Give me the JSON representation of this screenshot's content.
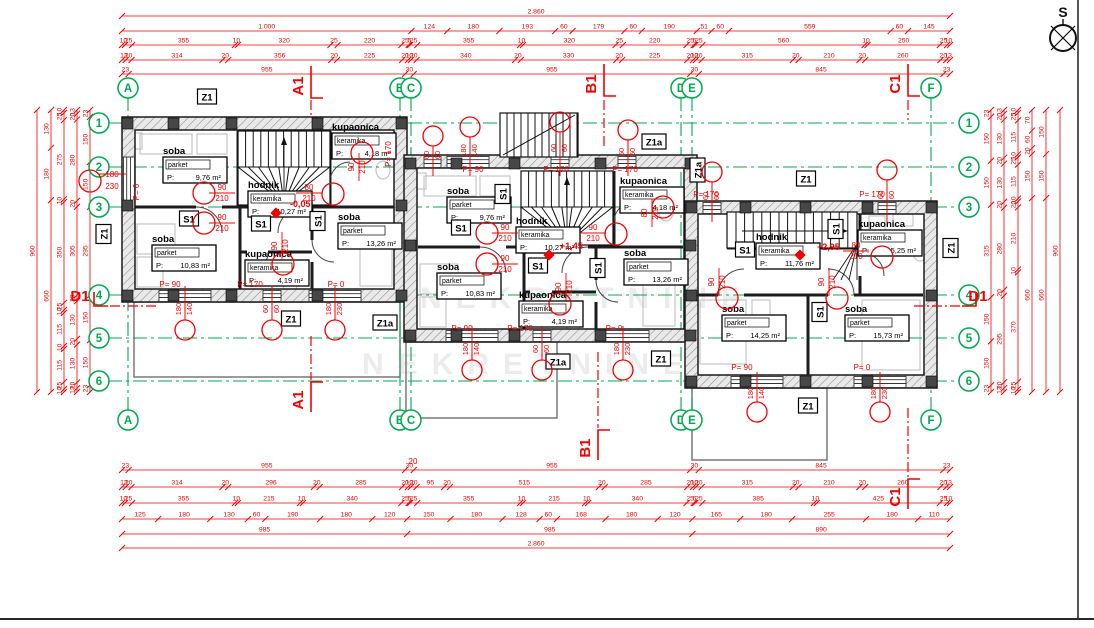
{
  "colors": {
    "red": "#f40000",
    "green": "#00a84f",
    "wall": "#1a1a1a",
    "furniture": "#c6c6c6",
    "terrace": "#6e6e6e",
    "watermark": "#ececec"
  },
  "compass": {
    "label": "S"
  },
  "watermark": {
    "text": "NEKRETNINE"
  },
  "axes": {
    "col_bubbles": [
      {
        "id": "A",
        "x": 128
      },
      {
        "id": "B",
        "x": 400
      },
      {
        "id": "C",
        "x": 411
      },
      {
        "id": "D",
        "x": 681
      },
      {
        "id": "E",
        "x": 692
      },
      {
        "id": "F",
        "x": 931
      }
    ],
    "row_bubbles": [
      {
        "id": "1",
        "y": 123
      },
      {
        "id": "2",
        "y": 167
      },
      {
        "id": "3",
        "y": 207
      },
      {
        "id": "4",
        "y": 295
      },
      {
        "id": "5",
        "y": 338
      },
      {
        "id": "6",
        "y": 381
      }
    ]
  },
  "dimensions": {
    "top": [
      {
        "y": 16,
        "values": [
          "2.860"
        ]
      },
      {
        "y": 31,
        "values": [
          "1.000",
          "124",
          "180",
          "193",
          "60",
          "179",
          "60",
          "190",
          "51",
          "60",
          "559",
          "60",
          "145"
        ]
      },
      {
        "y": 45,
        "values": [
          "10",
          "25",
          "355",
          "10",
          "320",
          "25",
          "220",
          "25",
          "5",
          "25",
          "355",
          "10",
          "320",
          "25",
          "220",
          "25",
          "5",
          "25",
          "560",
          "10",
          "250",
          "25",
          "10"
        ]
      },
      {
        "y": 60,
        "values": [
          "13",
          "20",
          "314",
          "20",
          "356",
          "20",
          "225",
          "20",
          "10",
          "20",
          "340",
          "20",
          "330",
          "20",
          "225",
          "20",
          "10",
          "20",
          "315",
          "20",
          "210",
          "20",
          "260",
          "20",
          "13"
        ]
      },
      {
        "y": 74,
        "values": [
          "23",
          "955",
          "30",
          "955",
          "30",
          "845",
          "23"
        ]
      }
    ],
    "bottom": [
      {
        "y": 470,
        "values": [
          "23",
          "955",
          "30",
          "955",
          "30",
          "845",
          "23"
        ]
      },
      {
        "y": 487,
        "values": [
          "13",
          "20",
          "314",
          "20",
          "296",
          "20",
          "285",
          "20",
          "10",
          "20",
          "95",
          "20",
          "515",
          "20",
          "285",
          "20",
          "10",
          "20",
          "315",
          "20",
          "210",
          "20",
          "260",
          "20",
          "13"
        ]
      },
      {
        "y": 503,
        "values": [
          "10",
          "25",
          "355",
          "10",
          "215",
          "10",
          "340",
          "25",
          "5",
          "25",
          "355",
          "10",
          "215",
          "10",
          "340",
          "25",
          "5",
          "25",
          "385",
          "10",
          "425",
          "25",
          "10"
        ]
      },
      {
        "y": 519,
        "values": [
          "125",
          "180",
          "130",
          "60",
          "190",
          "180",
          "120",
          "150",
          "180",
          "128",
          "60",
          "168",
          "180",
          "120",
          "165",
          "180",
          "255",
          "180",
          "110"
        ]
      },
      {
        "y": 534,
        "values": [
          "985",
          "985",
          "890"
        ]
      },
      {
        "y": 548,
        "values": [
          "2.860"
        ]
      }
    ],
    "left": [
      {
        "x": 37,
        "values": [
          "960"
        ]
      },
      {
        "x": 51,
        "values": [
          "130",
          "180",
          "660"
        ]
      },
      {
        "x": 64,
        "values": [
          "10",
          "25",
          "275",
          "10",
          "350",
          "25",
          "10",
          "115",
          "10",
          "115",
          "25",
          "10"
        ]
      },
      {
        "x": 77,
        "values": [
          "13",
          "20",
          "280",
          "20",
          "305",
          "20",
          "130",
          "20",
          "130",
          "20",
          "13"
        ]
      },
      {
        "x": 90,
        "values": [
          "23",
          "150",
          "150",
          "295",
          "150",
          "150",
          "23"
        ]
      }
    ],
    "right": [
      {
        "x": 991,
        "values": [
          "23",
          "150",
          "150",
          "315",
          "150",
          "150",
          "23"
        ]
      },
      {
        "x": 1004,
        "values": [
          "13",
          "20",
          "130",
          "20",
          "130",
          "20",
          "280",
          "20",
          "295",
          "20",
          "13"
        ]
      },
      {
        "x": 1018,
        "values": [
          "10",
          "25",
          "115",
          "10",
          "25",
          "115",
          "10",
          "20",
          "210",
          "10",
          "370",
          "25",
          "10"
        ]
      },
      {
        "x": 1032,
        "values": [
          "70",
          "60",
          "20",
          "150",
          "660"
        ]
      },
      {
        "x": 1046,
        "values": [
          "150",
          "150",
          "660"
        ]
      },
      {
        "x": 1060,
        "values": [
          "960"
        ]
      }
    ]
  },
  "sections": [
    {
      "t": "A1",
      "x": 303,
      "y": 86,
      "rot": true,
      "brk": [
        [
          311,
          66
        ],
        [
          311,
          98
        ],
        [
          323,
          98
        ]
      ],
      "dash": [
        311,
        100,
        311,
        116
      ]
    },
    {
      "t": "B1",
      "x": 596,
      "y": 84,
      "rot": true,
      "brk": [
        [
          604,
          64
        ],
        [
          604,
          96
        ],
        [
          616,
          96
        ]
      ],
      "dash": [
        604,
        100,
        604,
        148
      ]
    },
    {
      "t": "C1",
      "x": 900,
      "y": 84,
      "rot": true,
      "brk": [
        [
          908,
          64
        ],
        [
          908,
          96
        ],
        [
          920,
          96
        ]
      ],
      "dash": [
        908,
        100,
        908,
        120
      ]
    },
    {
      "t": "A1",
      "x": 303,
      "y": 400,
      "rot": true,
      "brk": [
        [
          311,
          412
        ],
        [
          311,
          382
        ],
        [
          323,
          382
        ]
      ],
      "dash": [
        311,
        336,
        311,
        380
      ]
    },
    {
      "t": "B1",
      "x": 590,
      "y": 448,
      "rot": true,
      "brk": [
        [
          598,
          460
        ],
        [
          598,
          430
        ],
        [
          610,
          430
        ]
      ],
      "dash": [
        598,
        352,
        598,
        428
      ]
    },
    {
      "t": "C1",
      "x": 900,
      "y": 497,
      "rot": true,
      "brk": [
        [
          908,
          509
        ],
        [
          908,
          479
        ],
        [
          920,
          479
        ]
      ],
      "dash": [
        908,
        408,
        908,
        477
      ]
    },
    {
      "t": "D1",
      "x": 80,
      "y": 301,
      "rot": false,
      "brk": [
        [
          94,
          292
        ],
        [
          94,
          306
        ],
        [
          108,
          306
        ]
      ],
      "dash": [
        110,
        306,
        158,
        306
      ]
    },
    {
      "t": "D1",
      "x": 978,
      "y": 301,
      "rot": false,
      "brk": [
        [
          976,
          292
        ],
        [
          976,
          306
        ],
        [
          962,
          306
        ]
      ],
      "dash": [
        960,
        306,
        914,
        306
      ]
    }
  ],
  "rooms": [
    {
      "n": "soba",
      "m": "parket",
      "a": "9,76",
      "x": 163,
      "y": 154
    },
    {
      "n": "kupaonica",
      "m": "keramika",
      "a": "4,18",
      "x": 332,
      "y": 130
    },
    {
      "n": "hodnik",
      "m": "keramika",
      "a": "10,27",
      "x": 248,
      "y": 188
    },
    {
      "n": "soba",
      "m": "parket",
      "a": "10,83",
      "x": 152,
      "y": 242
    },
    {
      "n": "kupaonica",
      "m": "keramika",
      "a": "4,19",
      "x": 245,
      "y": 257
    },
    {
      "n": "soba",
      "m": "parket",
      "a": "13,26",
      "x": 338,
      "y": 220
    },
    {
      "n": "soba",
      "m": "parket",
      "a": "9,76",
      "x": 447,
      "y": 194
    },
    {
      "n": "kupaonica",
      "m": "keramika",
      "a": "4,18",
      "x": 620,
      "y": 184
    },
    {
      "n": "hodnik",
      "m": "keramika",
      "a": "10,27",
      "x": 516,
      "y": 224
    },
    {
      "n": "soba",
      "m": "parket",
      "a": "10,83",
      "x": 437,
      "y": 270
    },
    {
      "n": "kupaonica",
      "m": "keramika",
      "a": "4,19",
      "x": 519,
      "y": 298
    },
    {
      "n": "soba",
      "m": "parket",
      "a": "13,26",
      "x": 624,
      "y": 256
    },
    {
      "n": "hodnik",
      "m": "keramika",
      "a": "11,76",
      "x": 756,
      "y": 240
    },
    {
      "n": "kupaonica",
      "m": "keramika",
      "a": "5,25",
      "x": 858,
      "y": 227
    },
    {
      "n": "soba",
      "m": "parket",
      "a": "14,25",
      "x": 722,
      "y": 312
    },
    {
      "n": "soba",
      "m": "parket",
      "a": "15,73",
      "x": 845,
      "y": 312
    }
  ],
  "markers": [
    {
      "t": "Z1",
      "x": 207,
      "y": 97,
      "rot": false
    },
    {
      "t": "Z1",
      "x": 104,
      "y": 234,
      "rot": true
    },
    {
      "t": "Z1",
      "x": 291,
      "y": 319,
      "rot": false
    },
    {
      "t": "Z1a",
      "x": 385,
      "y": 323,
      "rot": false
    },
    {
      "t": "Z1a",
      "x": 654,
      "y": 142,
      "rot": false
    },
    {
      "t": "Z1a",
      "x": 558,
      "y": 362,
      "rot": false
    },
    {
      "t": "Z1",
      "x": 661,
      "y": 359,
      "rot": false
    },
    {
      "t": "Z1a",
      "x": 698,
      "y": 170,
      "rot": true
    },
    {
      "t": "Z1",
      "x": 806,
      "y": 179,
      "rot": false
    },
    {
      "t": "Z1",
      "x": 951,
      "y": 248,
      "rot": true
    },
    {
      "t": "Z1",
      "x": 808,
      "y": 406,
      "rot": false
    },
    {
      "t": "S1",
      "x": 189,
      "y": 219,
      "rot": false
    },
    {
      "t": "S1",
      "x": 261,
      "y": 224,
      "rot": false
    },
    {
      "t": "S1",
      "x": 318,
      "y": 221,
      "rot": true
    },
    {
      "t": "S1",
      "x": 461,
      "y": 228,
      "rot": false
    },
    {
      "t": "S1",
      "x": 503,
      "y": 194,
      "rot": true
    },
    {
      "t": "S1",
      "x": 538,
      "y": 266,
      "rot": false
    },
    {
      "t": "S1",
      "x": 598,
      "y": 268,
      "rot": true
    },
    {
      "t": "S1",
      "x": 745,
      "y": 250,
      "rot": false
    },
    {
      "t": "S1",
      "x": 836,
      "y": 229,
      "rot": true
    },
    {
      "t": "S1",
      "x": 820,
      "y": 312,
      "rot": true
    }
  ],
  "levels": [
    {
      "t": "-0,05",
      "x": 288,
      "y": 207,
      "dx": 276,
      "dy": 213
    },
    {
      "t": "+1,45",
      "x": 558,
      "y": 249,
      "dx": 549,
      "dy": 255
    },
    {
      "t": "+2,95",
      "x": 815,
      "y": 250,
      "dx": 800,
      "dy": 255
    }
  ],
  "red_notes": [
    {
      "t": "20",
      "x": 413,
      "y": 464,
      "r": 0
    },
    {
      "t": "P= 0",
      "x": 139,
      "y": 192,
      "r": 1
    },
    {
      "t": "180",
      "x": 112,
      "y": 177,
      "r": 0
    },
    {
      "t": "230",
      "x": 112,
      "y": 189,
      "r": 0
    },
    {
      "t": "P= 170",
      "x": 391,
      "y": 154,
      "r": 1
    },
    {
      "t": "P= 90",
      "x": 170,
      "y": 287,
      "r": 0
    },
    {
      "t": "P= 170",
      "x": 250,
      "y": 287,
      "r": 0
    },
    {
      "t": "P= 0",
      "x": 336,
      "y": 287,
      "r": 0
    },
    {
      "t": "P= 90",
      "x": 473,
      "y": 172,
      "r": 0
    },
    {
      "t": "P= 170",
      "x": 556,
      "y": 172,
      "r": 0
    },
    {
      "t": "P= 170",
      "x": 625,
      "y": 172,
      "r": 0
    },
    {
      "t": "P= 90",
      "x": 462,
      "y": 331,
      "r": 0
    },
    {
      "t": "P= 170",
      "x": 520,
      "y": 331,
      "r": 0
    },
    {
      "t": "P= 0",
      "x": 614,
      "y": 331,
      "r": 0
    },
    {
      "t": "P= 170",
      "x": 706,
      "y": 197,
      "r": 0
    },
    {
      "t": "P= 170",
      "x": 872,
      "y": 197,
      "r": 0
    },
    {
      "t": "P= 90",
      "x": 742,
      "y": 370,
      "r": 0
    },
    {
      "t": "P= 0",
      "x": 862,
      "y": 370,
      "r": 0
    }
  ],
  "door_tags": [
    {
      "w": "90",
      "h": "210",
      "x": 222,
      "y": 190,
      "rot": false
    },
    {
      "w": "80",
      "h": "210",
      "x": 309,
      "y": 190,
      "rot": false
    },
    {
      "w": "90",
      "h": "210",
      "x": 222,
      "y": 220,
      "rot": false
    },
    {
      "w": "90",
      "h": "210",
      "x": 277,
      "y": 246,
      "rot": true
    },
    {
      "w": "90",
      "h": "210",
      "x": 354,
      "y": 167,
      "rot": true
    },
    {
      "w": "90",
      "h": "210",
      "x": 505,
      "y": 230,
      "rot": false
    },
    {
      "w": "90",
      "h": "210",
      "x": 593,
      "y": 230,
      "rot": false
    },
    {
      "w": "90",
      "h": "210",
      "x": 505,
      "y": 261,
      "rot": false
    },
    {
      "w": "90",
      "h": "210",
      "x": 561,
      "y": 287,
      "rot": true
    },
    {
      "w": "80",
      "h": "210",
      "x": 647,
      "y": 213,
      "rot": true
    },
    {
      "w": "90",
      "h": "210",
      "x": 714,
      "y": 282,
      "rot": true
    },
    {
      "w": "90",
      "h": "210",
      "x": 824,
      "y": 282,
      "rot": true
    },
    {
      "w": "80",
      "h": "210",
      "x": 856,
      "y": 248,
      "rot": false
    }
  ],
  "window_tags": [
    {
      "x": 185,
      "cy": 330,
      "wy": 302,
      "a": "180",
      "b": "140"
    },
    {
      "x": 272,
      "cy": 330,
      "wy": 302,
      "a": "60",
      "b": "60"
    },
    {
      "x": 335,
      "cy": 330,
      "wy": 302,
      "a": "180",
      "b": "230"
    },
    {
      "x": 472,
      "cy": 370,
      "wy": 342,
      "a": "180",
      "b": "140"
    },
    {
      "x": 542,
      "cy": 370,
      "wy": 342,
      "a": "60",
      "b": "60"
    },
    {
      "x": 623,
      "cy": 370,
      "wy": 342,
      "a": "180",
      "b": "230"
    },
    {
      "x": 433,
      "cy": 136,
      "wy": 160,
      "a": "60",
      "b": "60"
    },
    {
      "x": 470,
      "cy": 127,
      "wy": 160,
      "a": "180",
      "b": "140"
    },
    {
      "x": 560,
      "cy": 122,
      "wy": 160,
      "a": "60",
      "b": "60"
    },
    {
      "x": 628,
      "cy": 130,
      "wy": 160,
      "a": "60",
      "b": "60"
    },
    {
      "x": 712,
      "cy": 172,
      "wy": 206,
      "a": "60",
      "b": "60"
    },
    {
      "x": 887,
      "cy": 170,
      "wy": 206,
      "a": "60",
      "b": "60"
    },
    {
      "x": 757,
      "cy": 412,
      "wy": 388,
      "a": "180",
      "b": "140"
    },
    {
      "x": 880,
      "cy": 412,
      "wy": 388,
      "a": "180",
      "b": "230"
    }
  ],
  "red_circles": [
    [
      204,
      193
    ],
    [
      333,
      194
    ],
    [
      204,
      223
    ],
    [
      283,
      264
    ],
    [
      362,
      153
    ],
    [
      487,
      233
    ],
    [
      616,
      234
    ],
    [
      487,
      264
    ],
    [
      560,
      304
    ],
    [
      663,
      207
    ],
    [
      727,
      298
    ],
    [
      837,
      298
    ],
    [
      882,
      257
    ],
    [
      90,
      181
    ]
  ]
}
